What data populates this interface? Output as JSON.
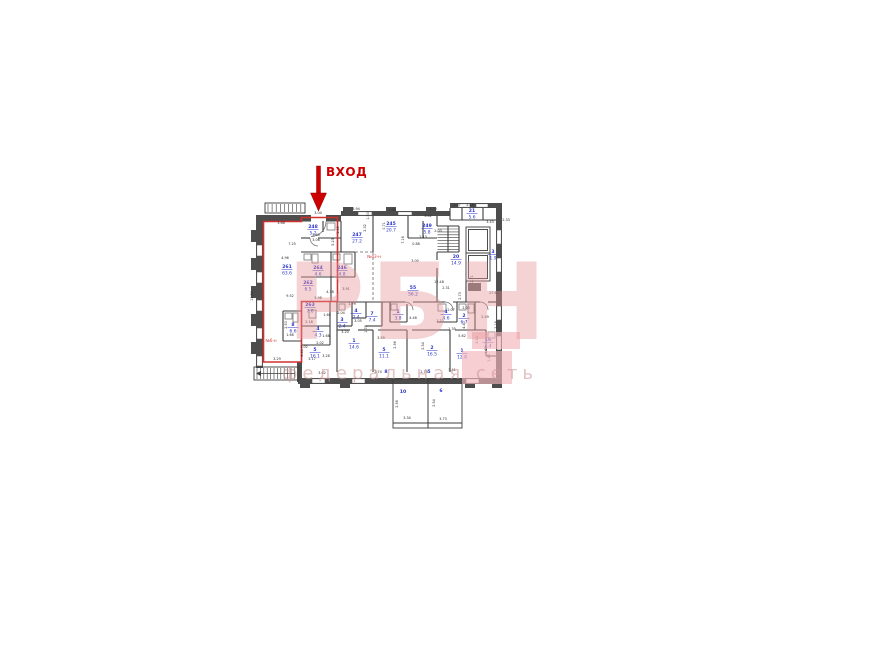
{
  "canvas": {
    "width": 870,
    "height": 652,
    "background": "#ffffff"
  },
  "entrance": {
    "label": "ВХОД",
    "color": "#cc0000",
    "arrow": {
      "shaft": [
        316.5,
        166,
        4,
        27
      ],
      "head": [
        [
          310.5,
          193
        ],
        [
          326.5,
          193
        ],
        [
          318.5,
          211
        ]
      ]
    }
  },
  "watermark": {
    "logo": "РБН",
    "tagline": "федеральная сеть",
    "logo_color": "rgba(231,148,152,0.42)",
    "tagline_color": "rgba(205,150,150,0.58)",
    "block_color": "rgba(242,180,184,0.65)",
    "blocks": [
      [
        472,
        332,
        48,
        17
      ],
      [
        462,
        351,
        50,
        33
      ]
    ]
  },
  "unit_labels": [
    {
      "text": "№6-н",
      "x": 271,
      "y": 342
    },
    {
      "text": "№43-н",
      "x": 374,
      "y": 258
    }
  ],
  "colors": {
    "wall": "#4d4d4d",
    "thin": "#3c3c3c",
    "dash": "#666666",
    "red": "#d03030",
    "blue": "#2b35c8",
    "dim": "#2a2a2a",
    "fixture": "#777777",
    "window_edge": "#555555"
  },
  "rooms": [
    [
      "248",
      "5.2",
      313,
      228
    ],
    [
      "247",
      "27.2",
      357,
      236
    ],
    [
      "245",
      "20.7",
      391,
      225
    ],
    [
      "249",
      "5.8",
      427,
      227
    ],
    [
      "21",
      "5.6",
      472,
      212
    ],
    [
      "3",
      "1.9",
      493,
      253
    ],
    [
      "20",
      "14.9",
      456,
      258
    ],
    [
      "261",
      "63.6",
      287,
      268
    ],
    [
      "264",
      "4.6",
      318,
      269
    ],
    [
      "246",
      "4.8",
      342,
      269
    ],
    [
      "262",
      "6.5",
      308,
      284
    ],
    [
      "263",
      "7.6",
      310,
      306
    ],
    [
      "55",
      "56.2",
      413,
      289
    ],
    [
      "8",
      "6.6",
      293,
      326
    ],
    [
      "4",
      "4.3",
      318,
      330
    ],
    [
      "3",
      "2.4",
      342,
      321
    ],
    [
      "4",
      "2.4",
      356,
      312
    ],
    [
      "7",
      "7.4",
      372,
      315
    ],
    [
      "1",
      "3.8",
      398,
      313
    ],
    [
      "4",
      "4.6",
      446,
      313
    ],
    [
      "2",
      "6.7",
      464,
      317
    ],
    [
      "1",
      "14.6",
      354,
      342
    ],
    [
      "5",
      "16.1",
      315,
      351
    ],
    [
      "5",
      "11.1",
      384,
      351
    ],
    [
      "2",
      "16.5",
      432,
      349
    ],
    [
      "1",
      "12.8",
      462,
      352
    ],
    [
      "16",
      "4.4",
      488,
      341
    ]
  ],
  "tags": [
    [
      "8",
      386,
      373
    ],
    [
      "5",
      429,
      373
    ],
    [
      "10",
      403,
      393
    ],
    [
      "6",
      441,
      392
    ]
  ],
  "dims": [
    [
      "3.04",
      318,
      214,
      0
    ],
    [
      "3.68",
      281,
      224,
      0
    ],
    [
      "3.60",
      316,
      236,
      0
    ],
    [
      "3.06",
      316,
      241,
      0
    ],
    [
      "1.45",
      339,
      230,
      1
    ],
    [
      "7.25",
      292,
      245,
      0
    ],
    [
      "4.96",
      285,
      259,
      0
    ],
    [
      "9.52",
      290,
      297,
      0
    ],
    [
      "13.80",
      253,
      296,
      1
    ],
    [
      "5.23",
      334,
      242,
      1
    ],
    [
      "3.91",
      346,
      290,
      0
    ],
    [
      "4.38",
      330,
      293,
      0
    ],
    [
      "3.98",
      318,
      299,
      0
    ],
    [
      "1.60",
      327,
      316,
      0
    ],
    [
      "2.04",
      341,
      314,
      0
    ],
    [
      "1.68",
      326,
      337,
      0
    ],
    [
      "2.02",
      320,
      344,
      0
    ],
    [
      "3.20",
      345,
      333,
      0
    ],
    [
      "2.50",
      287,
      325,
      1
    ],
    [
      "1.66",
      290,
      336,
      0
    ],
    [
      "2.18",
      309,
      323,
      0
    ],
    [
      "3.17",
      312,
      360,
      0
    ],
    [
      "3.28",
      326,
      357,
      0
    ],
    [
      "4.40",
      303,
      353,
      1
    ],
    [
      "3.29",
      277,
      360,
      0
    ],
    [
      "3.62",
      322,
      374,
      0
    ],
    [
      "3.94",
      356,
      210,
      0
    ],
    [
      "1.50",
      369,
      216,
      1
    ],
    [
      "2.08",
      392,
      211,
      0
    ],
    [
      "3.20",
      433,
      210,
      0
    ],
    [
      "2.32",
      366,
      228,
      1
    ],
    [
      "0.71",
      385,
      226,
      1
    ],
    [
      "7.16",
      404,
      240,
      1
    ],
    [
      "0.88",
      416,
      245,
      0
    ],
    [
      "2.13",
      423,
      238,
      0
    ],
    [
      "2.03",
      438,
      232,
      0
    ],
    [
      "3.42",
      428,
      217,
      0
    ],
    [
      "1.27",
      457,
      206,
      0
    ],
    [
      "2.28",
      470,
      206,
      0
    ],
    [
      "3.43",
      490,
      223,
      0
    ],
    [
      "2.33",
      506,
      221,
      0
    ],
    [
      "3.00",
      415,
      262,
      0
    ],
    [
      "12.48",
      439,
      283,
      0
    ],
    [
      "27.61",
      494,
      294,
      0
    ],
    [
      "2.31",
      446,
      289,
      0
    ],
    [
      "2.73",
      461,
      296,
      1
    ],
    [
      "2.71",
      473,
      279,
      1
    ],
    [
      "2.07",
      451,
      311,
      0
    ],
    [
      "2.03",
      466,
      309,
      0
    ],
    [
      "2.49",
      485,
      318,
      0
    ],
    [
      "2.16",
      497,
      325,
      1
    ],
    [
      "4.48",
      413,
      319,
      0
    ],
    [
      "1.22",
      440,
      322,
      0
    ],
    [
      "1.35",
      452,
      330,
      0
    ],
    [
      "5.62",
      462,
      337,
      0
    ],
    [
      "4.40",
      465,
      325,
      1
    ],
    [
      "3.24",
      478,
      340,
      1
    ],
    [
      "4.38",
      487,
      350,
      1
    ],
    [
      "3.05",
      358,
      322,
      0
    ],
    [
      "1.78",
      367,
      329,
      1
    ],
    [
      "1.79",
      352,
      305,
      0
    ],
    [
      "2.56",
      396,
      345,
      1
    ],
    [
      "2.54",
      424,
      346,
      1
    ],
    [
      "3.59",
      381,
      339,
      0
    ],
    [
      "2.74",
      378,
      373,
      0
    ],
    [
      "2.79",
      424,
      373,
      0
    ],
    [
      "3.41",
      452,
      371,
      0
    ],
    [
      "2.56",
      398,
      404,
      1
    ],
    [
      "2.54",
      435,
      403,
      1
    ],
    [
      "3.34",
      407,
      419,
      0
    ],
    [
      "3.73",
      443,
      420,
      0
    ],
    [
      "5.02",
      304,
      348,
      0
    ],
    [
      "1.42",
      490,
      358,
      1
    ]
  ],
  "plan": {
    "walls": [
      [
        256,
        215,
        7,
        153
      ],
      [
        251,
        230,
        5,
        12
      ],
      [
        251,
        258,
        5,
        12
      ],
      [
        251,
        286,
        5,
        12
      ],
      [
        251,
        314,
        5,
        12
      ],
      [
        251,
        342,
        5,
        12
      ],
      [
        256,
        215,
        55,
        6.5
      ],
      [
        326,
        215,
        15,
        6.5
      ],
      [
        341,
        211,
        109,
        5
      ],
      [
        343,
        207,
        10,
        4
      ],
      [
        386,
        207,
        10,
        4
      ],
      [
        426,
        207,
        10,
        4
      ],
      [
        450,
        203,
        52,
        5
      ],
      [
        496,
        203,
        6,
        175
      ],
      [
        298,
        378,
        204,
        6
      ],
      [
        300,
        384,
        10,
        4
      ],
      [
        340,
        384,
        10,
        4
      ],
      [
        465,
        384,
        10,
        4
      ],
      [
        492,
        384,
        10,
        4
      ],
      [
        297,
        362,
        5,
        20
      ]
    ],
    "windows": [
      [
        256.8,
        245,
        5.4,
        11
      ],
      [
        256.8,
        272,
        5.4,
        11
      ],
      [
        256.8,
        300,
        5.4,
        11
      ],
      [
        256.8,
        328,
        5.4,
        11
      ],
      [
        256.8,
        356,
        5.4,
        10
      ],
      [
        312,
        378.8,
        13,
        4.4
      ],
      [
        352,
        378.8,
        13,
        4.4
      ],
      [
        466,
        378.8,
        13,
        4.4
      ],
      [
        496.8,
        230,
        4.4,
        14
      ],
      [
        496.8,
        258,
        4.4,
        14
      ],
      [
        496.8,
        306,
        4.4,
        14
      ],
      [
        496.8,
        336,
        4.4,
        14
      ],
      [
        358,
        211.8,
        14,
        3.4
      ],
      [
        398,
        211.8,
        14,
        3.4
      ],
      [
        458,
        203.8,
        12,
        3.4
      ],
      [
        476,
        203.8,
        12,
        3.4
      ]
    ],
    "lines": [
      [
        301,
        238,
        310,
        238
      ],
      [
        318,
        238,
        341,
        238
      ],
      [
        323,
        221,
        323,
        232
      ],
      [
        341,
        221,
        341,
        252
      ],
      [
        373,
        216,
        373,
        252
      ],
      [
        301,
        252,
        355,
        252
      ],
      [
        301,
        277,
        331,
        277
      ],
      [
        331,
        252,
        331,
        302
      ],
      [
        355,
        252,
        355,
        277
      ],
      [
        331,
        277,
        355,
        277
      ],
      [
        408,
        216,
        408,
        238
      ],
      [
        408,
        238,
        437,
        238
      ],
      [
        423,
        221,
        423,
        238
      ],
      [
        437,
        216,
        437,
        226
      ],
      [
        437,
        252,
        437,
        260
      ],
      [
        437,
        268,
        437,
        302
      ],
      [
        437,
        226,
        459,
        226
      ],
      [
        459,
        226,
        459,
        252
      ],
      [
        437,
        252,
        459,
        252
      ],
      [
        448,
        226,
        448,
        252
      ],
      [
        466,
        281,
        466,
        302
      ],
      [
        462,
        208,
        462,
        220
      ],
      [
        483,
        208,
        483,
        220
      ],
      [
        450,
        220,
        496,
        220
      ],
      [
        450,
        208,
        450,
        220
      ],
      [
        337,
        302,
        405,
        302
      ],
      [
        413,
        302,
        445,
        302
      ],
      [
        453,
        302,
        480,
        302
      ],
      [
        488,
        302,
        496,
        302
      ],
      [
        337,
        302,
        337,
        372
      ],
      [
        373,
        330,
        373,
        372
      ],
      [
        407,
        330,
        407,
        372
      ],
      [
        450,
        330,
        450,
        372
      ],
      [
        407,
        304,
        407,
        322
      ],
      [
        352,
        302,
        352,
        326
      ],
      [
        337,
        326,
        352,
        326
      ],
      [
        366,
        302,
        366,
        318
      ],
      [
        352,
        318,
        366,
        318
      ],
      [
        382,
        302,
        382,
        326
      ],
      [
        366,
        326,
        382,
        326
      ],
      [
        390,
        302,
        390,
        322
      ],
      [
        390,
        322,
        407,
        322
      ],
      [
        457,
        302,
        457,
        322
      ],
      [
        437,
        322,
        457,
        322
      ],
      [
        475,
        302,
        475,
        330
      ],
      [
        457,
        330,
        475,
        330
      ],
      [
        486,
        330,
        486,
        356
      ],
      [
        486,
        356,
        496,
        356
      ],
      [
        283,
        311,
        301,
        311
      ],
      [
        283,
        311,
        283,
        341
      ],
      [
        283,
        341,
        301,
        341
      ],
      [
        301,
        326,
        330,
        326
      ],
      [
        330,
        302,
        330,
        345
      ],
      [
        301,
        345,
        330,
        345
      ],
      [
        337,
        330,
        350,
        330
      ],
      [
        358,
        330,
        373,
        330
      ],
      [
        378,
        330,
        407,
        330
      ],
      [
        412,
        330,
        450,
        330
      ],
      [
        455,
        330,
        486,
        330
      ],
      [
        393,
        423,
        462,
        423
      ]
    ],
    "dashed": [
      [
        373,
        252,
        373,
        300
      ],
      [
        355,
        252,
        373,
        252
      ]
    ],
    "wrects": [
      [
        265,
        203,
        40,
        10
      ],
      [
        254,
        367,
        45,
        13
      ],
      [
        393,
        379,
        35,
        49
      ],
      [
        428,
        379,
        34,
        49
      ],
      [
        466,
        227,
        24,
        26
      ],
      [
        466,
        253,
        24,
        28
      ],
      [
        468.5,
        229.5,
        19,
        21
      ],
      [
        468.5,
        255.5,
        19,
        23
      ]
    ],
    "darkrects": [
      [
        468,
        283,
        13,
        8
      ]
    ],
    "frects": [
      [
        327,
        223,
        8,
        7
      ],
      [
        304,
        254,
        7,
        6
      ],
      [
        312,
        254,
        6,
        9
      ],
      [
        333,
        254,
        7,
        6
      ],
      [
        344,
        254,
        8,
        10
      ],
      [
        285,
        313,
        7,
        6
      ],
      [
        293,
        313,
        5,
        9
      ],
      [
        309,
        310,
        7,
        8
      ],
      [
        339,
        304,
        6,
        6
      ],
      [
        459,
        304,
        7,
        6
      ],
      [
        468,
        304,
        6,
        9
      ],
      [
        488,
        332,
        7,
        6
      ],
      [
        438,
        304,
        8,
        7
      ],
      [
        391,
        304,
        6,
        6
      ]
    ],
    "ticks": [
      {
        "type": "v",
        "x": 268,
        "y": 204,
        "len": 8,
        "n": 9,
        "step": 4.1
      },
      {
        "type": "v",
        "x": 257,
        "y": 368,
        "len": 11,
        "n": 12,
        "step": 3.4
      },
      {
        "type": "h",
        "x": 437.5,
        "y": 229,
        "len": 21,
        "n": 8,
        "step": 2.9
      }
    ],
    "arcs": [
      "M326,221.5 A15,15 0 0 1 311,236.5",
      "M310,238 A8,8 0 0 0 318,246",
      "M405,302 A8,8 0 0 1 413,310",
      "M445,302 A8,8 0 0 1 453,310",
      "M480,302 A8,8 0 0 1 488,310"
    ],
    "stair_arrow": {
      "line": [
        295,
        373.5,
        261,
        373.5
      ],
      "head": [
        [
          261,
          371
        ],
        [
          256,
          373.5
        ],
        [
          261,
          376
        ]
      ]
    },
    "red_outline": [
      [
        263.5,
        221.5
      ],
      [
        301.5,
        221.5
      ],
      [
        301.5,
        217.5
      ],
      [
        337.5,
        217.5
      ],
      [
        337.5,
        301.5
      ],
      [
        301.5,
        301.5
      ],
      [
        301.5,
        362
      ],
      [
        263.5,
        362
      ]
    ]
  }
}
